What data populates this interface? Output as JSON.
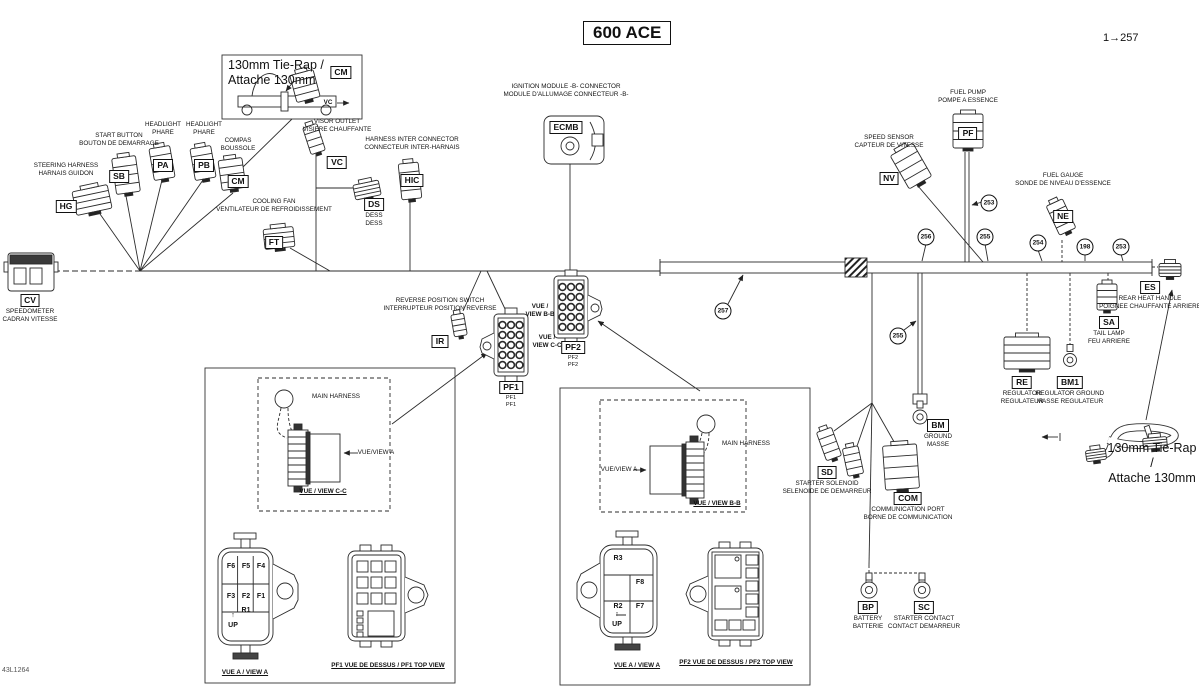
{
  "title": "600 ACE",
  "page_ref": "1→257",
  "sheet_id": "43L1264",
  "tie_rap": {
    "line1": "130mm Tie-Rap /",
    "line2": "Attache 130mm"
  },
  "connectors": [
    {
      "code": "HG",
      "en": "STEERING HARNESS",
      "fr": "HARNAIS GUIDON",
      "x": 66,
      "top": 162,
      "pos": "above"
    },
    {
      "code": "SB",
      "en": "START BUTTON",
      "fr": "BOUTON DE DEMARRAGE",
      "x": 119,
      "top": 132,
      "pos": "above"
    },
    {
      "code": "PA",
      "en": "HEADLIGHT",
      "fr": "PHARE",
      "x": 163,
      "top": 121,
      "pos": "above"
    },
    {
      "code": "PB",
      "en": "HEADLIGHT",
      "fr": "PHARE",
      "x": 204,
      "top": 121,
      "pos": "above"
    },
    {
      "code": "CM",
      "en": "COMPAS",
      "fr": "BOUSSOLE",
      "x": 238,
      "top": 137,
      "pos": "above"
    },
    {
      "code": "VC",
      "en": "VISOR OUTLET",
      "fr": "VISIERE CHAUFFANTE",
      "x": 337,
      "top": 118,
      "pos": "above"
    },
    {
      "code": "HIC",
      "en": "HARNESS INTER CONNECTOR",
      "fr": "CONNECTEUR INTER-HARNAIS",
      "x": 412,
      "top": 136,
      "pos": "above"
    },
    {
      "code": "DS",
      "en": "DESS",
      "fr": "DESS",
      "x": 374,
      "top": 194,
      "pos": "below"
    },
    {
      "code": "FT",
      "en": "COOLING FAN",
      "fr": "VENTILATEUR DE REFROIDISSEMENT",
      "x": 274,
      "top": 198,
      "pos": "above"
    },
    {
      "code": "CV",
      "en": "SPEEDOMETER",
      "fr": "CADRAN VITESSE",
      "x": 30,
      "top": 290,
      "pos": "below"
    },
    {
      "code": "ECMB",
      "en": "IGNITION MODULE -B- CONNECTOR",
      "fr": "MODULE D'ALLUMAGE CONNECTEUR -B-",
      "x": 566,
      "top": 83,
      "pos": "above"
    },
    {
      "code": "PF",
      "en": "FUEL PUMP",
      "fr": "POMPE A ESSENCE",
      "x": 968,
      "top": 89,
      "pos": "above"
    },
    {
      "code": "NV",
      "en": "SPEED SENSOR",
      "fr": "CAPTEUR DE VITESSE",
      "x": 889,
      "top": 134,
      "pos": "above"
    },
    {
      "code": "NE",
      "en": "FUEL GAUGE",
      "fr": "SONDE DE NIVEAU D'ESSENCE",
      "x": 1063,
      "top": 172,
      "pos": "above"
    },
    {
      "code": "SA",
      "en": "TAIL LAMP",
      "fr": "FEU ARRIERE",
      "x": 1109,
      "top": 312,
      "pos": "below"
    },
    {
      "code": "ES",
      "en": "REAR HEAT HANDLE",
      "fr": "POIGNEE CHAUFFANTE ARRIERE",
      "x": 1150,
      "top": 277,
      "pos": "below"
    },
    {
      "code": "RE",
      "en": "REGULATOR",
      "fr": "REGULATEUR",
      "x": 1022,
      "top": 372,
      "pos": "below"
    },
    {
      "code": "BM1",
      "en": "REGULATOR GROUND",
      "fr": "MASSE REGULATEUR",
      "x": 1070,
      "top": 372,
      "pos": "below"
    },
    {
      "code": "BM",
      "en": "GROUND",
      "fr": "MASSE",
      "x": 938,
      "top": 415,
      "pos": "below"
    },
    {
      "code": "SD",
      "en": "STARTER SOLENOID",
      "fr": "SELENOIDE DE DEMARREUR",
      "x": 827,
      "top": 462,
      "pos": "below"
    },
    {
      "code": "COM",
      "en": "COMMUNICATION PORT",
      "fr": "BORNE DE COMMUNICATION",
      "x": 908,
      "top": 488,
      "pos": "below"
    },
    {
      "code": "BP",
      "en": "BATTERY",
      "fr": "BATTERIE",
      "x": 868,
      "top": 597,
      "pos": "below"
    },
    {
      "code": "SC",
      "en": "STARTER CONTACT",
      "fr": "CONTACT DEMARREUR",
      "x": 924,
      "top": 597,
      "pos": "below"
    },
    {
      "code": "IR",
      "en": "REVERSE POSITION SWITCH",
      "fr": "INTERRUPTEUR POSITION REVERSE",
      "x": 440,
      "top": 297,
      "pos": "above"
    },
    {
      "code": "PF1",
      "en": "PF1",
      "fr": "PF1",
      "x": 511,
      "top": 377,
      "pos": "below",
      "small": true
    },
    {
      "code": "PF2",
      "en": "PF2",
      "fr": "PF2",
      "x": 573,
      "top": 337,
      "pos": "below",
      "small": true
    },
    {
      "code": "CM",
      "en": "",
      "fr": "",
      "x": 341,
      "top": 62,
      "pos": "none"
    }
  ],
  "part_refs": [
    {
      "num": "257",
      "x": 723,
      "y": 311
    },
    {
      "num": "255",
      "x": 898,
      "y": 336
    },
    {
      "num": "253",
      "x": 989,
      "y": 203
    },
    {
      "num": "256",
      "x": 926,
      "y": 237
    },
    {
      "num": "255",
      "x": 985,
      "y": 237
    },
    {
      "num": "254",
      "x": 1038,
      "y": 243
    },
    {
      "num": "198",
      "x": 1085,
      "y": 247
    },
    {
      "num": "253",
      "x": 1121,
      "y": 247
    }
  ],
  "notes": [
    {
      "text": "VUE /\nVIEW B-B",
      "x": 540,
      "y": 303,
      "b": 1
    },
    {
      "text": "VUE /\nVIEW C-C",
      "x": 547,
      "y": 334,
      "b": 1
    },
    {
      "text": "MAIN HARNESS",
      "x": 336,
      "y": 393
    },
    {
      "text": "VUE/VIEW A",
      "x": 376,
      "y": 449
    },
    {
      "text": "VUE / VIEW C-C",
      "x": 323,
      "y": 488,
      "u": 1,
      "b": 1
    },
    {
      "text": "MAIN HARNESS",
      "x": 746,
      "y": 440
    },
    {
      "text": "VUE/VIEW A",
      "x": 619,
      "y": 466
    },
    {
      "text": "VUE / VIEW B-B",
      "x": 717,
      "y": 500,
      "u": 1,
      "b": 1
    },
    {
      "text": "VUE A / VIEW A",
      "x": 245,
      "y": 669,
      "u": 1,
      "b": 1
    },
    {
      "text": "PF1 VUE DE DESSUS / PF1 TOP VIEW",
      "x": 388,
      "y": 662,
      "u": 1,
      "b": 1
    },
    {
      "text": "VUE A / VIEW A",
      "x": 637,
      "y": 662,
      "u": 1,
      "b": 1
    },
    {
      "text": "PF2 VUE DE DESSUS / PF2 TOP VIEW",
      "x": 736,
      "y": 659,
      "u": 1,
      "b": 1
    },
    {
      "text": "VC",
      "x": 328,
      "y": 99,
      "b": 1
    }
  ],
  "fuse_cells": [
    {
      "t": "F6",
      "x": 231,
      "y": 563
    },
    {
      "t": "F5",
      "x": 246,
      "y": 563
    },
    {
      "t": "F4",
      "x": 261,
      "y": 563
    },
    {
      "t": "F3",
      "x": 231,
      "y": 593
    },
    {
      "t": "F2",
      "x": 246,
      "y": 593
    },
    {
      "t": "F1",
      "x": 261,
      "y": 593
    },
    {
      "t": "R1",
      "x": 246,
      "y": 607
    },
    {
      "t": "↑",
      "x": 233,
      "y": 612
    },
    {
      "t": "UP",
      "x": 233,
      "y": 622
    },
    {
      "t": "R3",
      "x": 618,
      "y": 555
    },
    {
      "t": "F8",
      "x": 640,
      "y": 579
    },
    {
      "t": "R2",
      "x": 618,
      "y": 603
    },
    {
      "t": "F7",
      "x": 640,
      "y": 603
    },
    {
      "t": "↑",
      "x": 617,
      "y": 611
    },
    {
      "t": "UP",
      "x": 617,
      "y": 621
    }
  ]
}
